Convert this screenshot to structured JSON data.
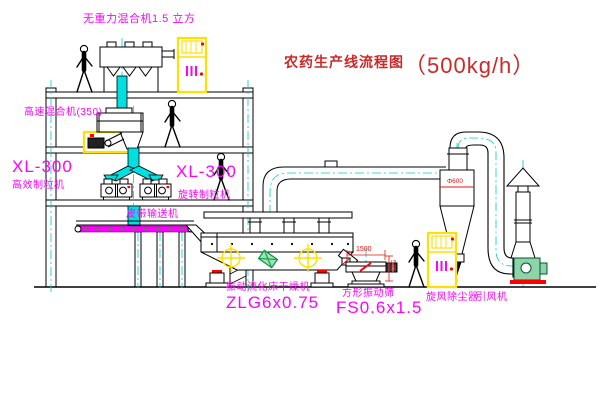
{
  "title": {
    "name": "农药生产线流程图",
    "capacity": "（500kg/h）"
  },
  "labels": {
    "weightless_mixer": "无重力混合机1.5 立方",
    "high_speed_mixer": "高速混合机(350)",
    "granulator_left_model": "XL-300",
    "granulator_left_name": "高效制粒机",
    "granulator_right_model": "XL-300",
    "granulator_right_name": "旋转制粒机",
    "belt_conveyor": "皮带输送机",
    "dryer_name": "振动流化床干燥机",
    "dryer_model": "ZLG6x0.75",
    "screen_name": "方形振动筛",
    "screen_model": "FS0.6x1.5",
    "cyclone": "旋风除尘器",
    "fan": "引风机"
  },
  "dimensions": {
    "screen_length": "1500",
    "screen_height": "545",
    "cyclone_diameter": "Φ600"
  },
  "colors": {
    "label_magenta": "#ff00ff",
    "title_red": "#cc2929",
    "dimension_red": "#ee1111",
    "line_black": "#000000",
    "chute_cyan": "#00e0e0",
    "highlight_yellow": "#ffe000",
    "marker_green": "#009944"
  }
}
